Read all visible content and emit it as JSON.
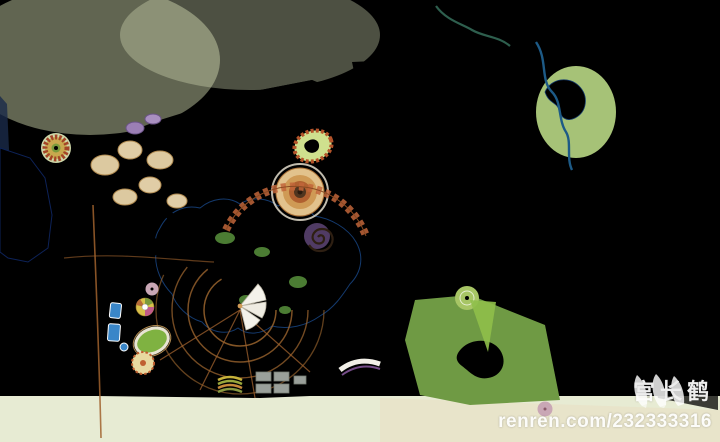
{
  "watermark": {
    "logo_icon": "three-wing-bird-logo",
    "artist_name": "宫长鹤",
    "credit_url": "renren.com/232333316",
    "text_color": "#ffffff"
  },
  "palette": {
    "wash_pale": "#e8ead2",
    "wash_beige": "#ece3c9",
    "field_green": "#ccdca4",
    "park_base": "#64913c",
    "residential_green": "#9cb86b",
    "grid_base": "#b9c98f",
    "canopy_dark": "#2c5423",
    "canopy_mid": "#3f6f2c",
    "canopy_light": "#609636",
    "lake_deep": "#13307a",
    "lake_main": "#1f4c9c",
    "lake_light": "#2e66b5",
    "stream_blue": "#2a63a8",
    "road_gray": "#8a8d85",
    "street_purple": "#8d80a0",
    "building_white": "#f4f4ee",
    "accent_orange": "#d2691e",
    "accent_red": "#b5452a",
    "resort_tan": "#d7a569",
    "sand_tan": "#d9c08f"
  }
}
